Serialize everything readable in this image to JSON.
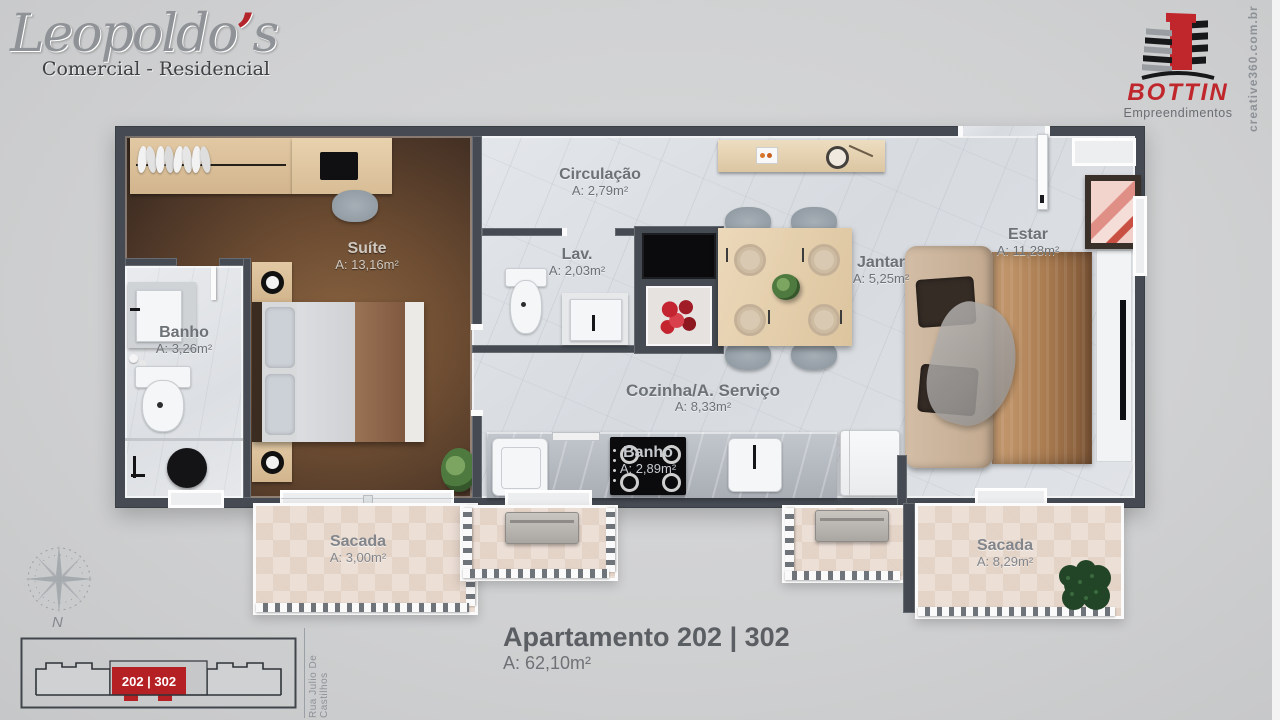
{
  "branding": {
    "leopoldos": {
      "name_pre": "Leopoldo",
      "apostrophe": "’",
      "name_post": "s",
      "tagline": "Comercial - Residencial"
    },
    "bottin": {
      "name": "BOTTIN",
      "tagline": "Empreendimentos"
    },
    "watermark": "creative360.com.br"
  },
  "rooms": {
    "circulacao": {
      "label": "Circulação",
      "area": "A: 2,79m²"
    },
    "suite": {
      "label": "Suíte",
      "area": "A: 13,16m²"
    },
    "banho_suite": {
      "label": "Banho",
      "area": "A: 3,26m²"
    },
    "lavabo": {
      "label": "Lav.",
      "area": "A: 2,03m²"
    },
    "jantar": {
      "label": "Jantar",
      "area": "A: 5,25m²"
    },
    "estar": {
      "label": "Estar",
      "area": "A: 11,28m²"
    },
    "cozinha": {
      "label": "Cozinha/A. Serviço",
      "area": "A: 8,33m²"
    },
    "banho_social": {
      "label": "Banho",
      "area": "A: 2,89m²"
    },
    "sacada_suite": {
      "label": "Sacada",
      "area": "A: 3,00m²"
    },
    "sacada_estar": {
      "label": "Sacada",
      "area": "A: 8,29m²"
    }
  },
  "footer": {
    "title": "Apartamento 202 | 302",
    "total_area": "A: 62,10m²",
    "compass_north": "N",
    "keyplan_unit": "202 | 302",
    "street": "Rua Julio De Castilhos"
  },
  "colors": {
    "accent_red": "#c0272d",
    "wall": "#464b53",
    "marble": "#dfe3e8",
    "wood": "#5a4430",
    "tile": "#ecdfd6"
  }
}
